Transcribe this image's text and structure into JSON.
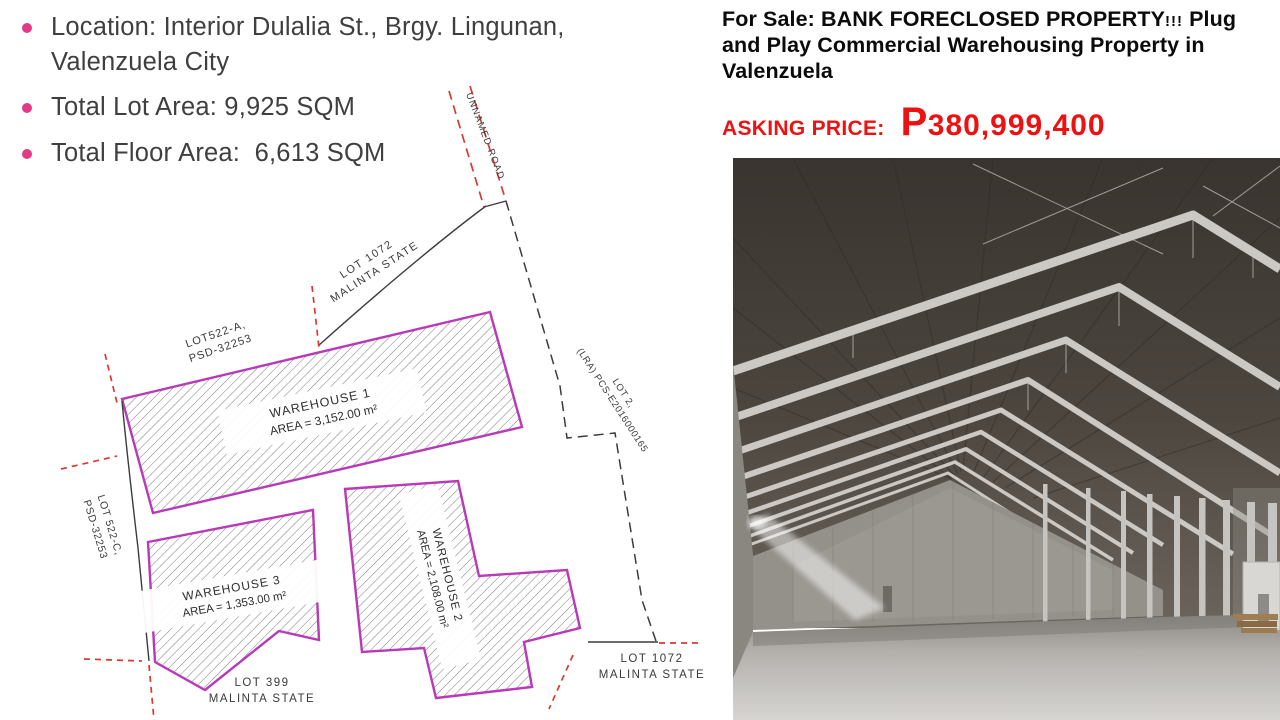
{
  "slide": {
    "bullets": [
      "Location: Interior Dulalia St., Brgy. Lingunan, Valenzuela City",
      "Total Lot Area: 9,925 SQM",
      "Total Floor Area:  6,613 SQM"
    ],
    "colors": {
      "bullet": "#e23a86",
      "body_text": "#3f3f3f"
    }
  },
  "listing": {
    "for_sale_prefix": "For Sale:",
    "headline_caps": "BANK FORECLOSED PROPERTY",
    "headline_bangs": "!!!",
    "headline_rest": "Plug and Play Commercial Warehousing Property in Valenzuela",
    "asking_price_label": "ASKING PRICE:",
    "currency_symbol": "P",
    "price": "380,999,400",
    "colors": {
      "headline": "#0b0b0b",
      "price_red": "#ee1111"
    }
  },
  "site_plan": {
    "road_label": "UNNAMED ROAD",
    "labels": {
      "lot1072_top": {
        "line1": "LOT 1072",
        "line2": "MALINTA STATE"
      },
      "lot522a": {
        "line1": "LOT522-A,",
        "line2": "PSD-32253"
      },
      "lot2": {
        "line1": "LOT 2,",
        "line2": "(LRA) PCS-E2016000165"
      },
      "lot522c": {
        "line1": "LOT 522-C,",
        "line2": "PSD-32253"
      },
      "lot399": {
        "line1": "LOT 399",
        "line2": "MALINTA STATE"
      },
      "lot1072_bottom": {
        "line1": "LOT 1072",
        "line2": "MALINTA STATE"
      }
    },
    "warehouses": [
      {
        "name": "WAREHOUSE 1",
        "area": "AREA = 3,152.00 m²"
      },
      {
        "name": "WAREHOUSE 2",
        "area": "AREA = 2,108.00 m²"
      },
      {
        "name": "WAREHOUSE 3",
        "area": "AREA = 1,353.00 m²"
      }
    ],
    "colors": {
      "outline": "#b83ab8",
      "survey_tick": "#d93a30",
      "boundary": "#3c3c3c"
    }
  }
}
